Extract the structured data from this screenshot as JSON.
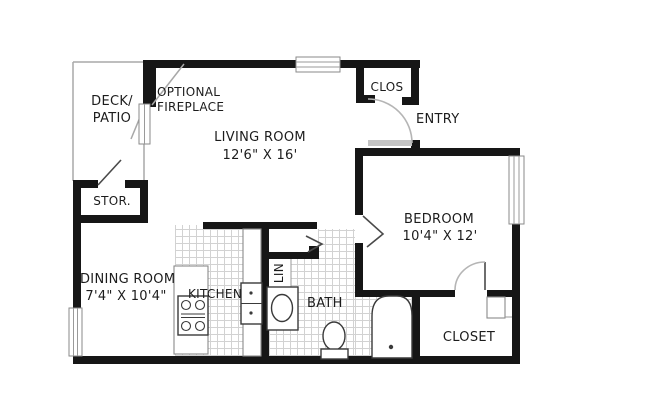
{
  "title": "One-bedroom apartment floor plan",
  "labels": {
    "fireplace_1": "OPTIONAL",
    "fireplace_2": "FIREPLACE",
    "deck_1": "DECK/",
    "deck_2": "PATIO",
    "living_name": "LIVING ROOM",
    "living_dims": "12'6\" X 16'",
    "clos": "CLOS",
    "entry": "ENTRY",
    "stor": "STOR.",
    "bedroom_name": "BEDROOM",
    "bedroom_dims": "10'4\" X 12'",
    "dining_name": "DINING ROOM",
    "dining_dims": "7'4\" X 10'4\"",
    "kitchen": "KITCHEN",
    "lin": "LIN",
    "bath": "BATH",
    "closet": "CLOSET"
  },
  "rooms": [
    {
      "name": "LIVING ROOM",
      "dims": "12'6\" X 16'"
    },
    {
      "name": "DINING ROOM",
      "dims": "7'4\" X 10'4\""
    },
    {
      "name": "BEDROOM",
      "dims": "10'4\" X 12'"
    },
    {
      "name": "KITCHEN",
      "dims": ""
    },
    {
      "name": "BATH",
      "dims": ""
    },
    {
      "name": "DECK/PATIO",
      "dims": ""
    },
    {
      "name": "STOR.",
      "dims": ""
    },
    {
      "name": "CLOS",
      "dims": ""
    },
    {
      "name": "ENTRY",
      "dims": ""
    },
    {
      "name": "LIN",
      "dims": ""
    },
    {
      "name": "CLOSET",
      "dims": ""
    }
  ],
  "colors": {
    "wall": "#161616",
    "tile_line": "#d2d2d2",
    "thin_line": "#a8a8a8",
    "door_leaf": "#c4c4c4",
    "fixture": "#3a3a3a",
    "text": "#1c1c1c",
    "background": "#ffffff"
  }
}
